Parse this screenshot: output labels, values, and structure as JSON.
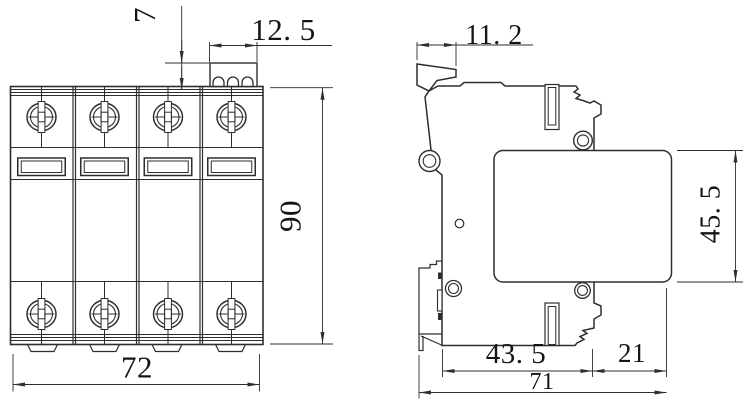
{
  "dimensions": {
    "front": {
      "block_height": "7",
      "block_width": "12. 5",
      "body_height": "90",
      "body_width": "72"
    },
    "side": {
      "tab_width": "11. 2",
      "module_height": "45. 5",
      "base_depth": "43. 5",
      "right_overhang": "21",
      "total_depth": "71"
    }
  },
  "colors": {
    "line": "#2e2e2e",
    "dimension_text": "#141414",
    "background": "#ffffff"
  }
}
